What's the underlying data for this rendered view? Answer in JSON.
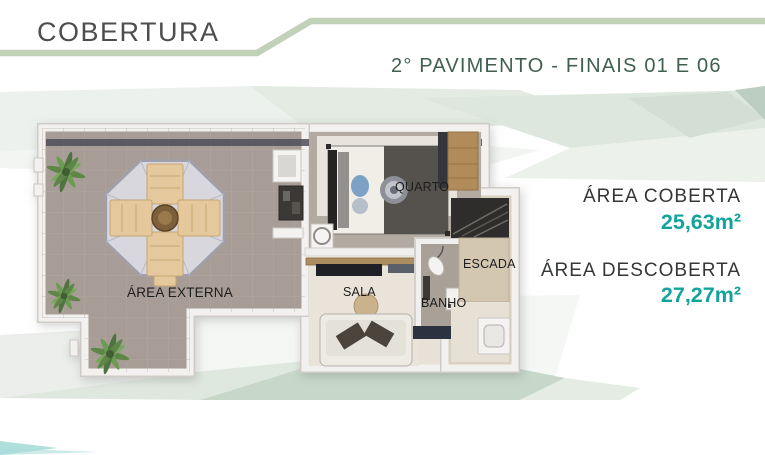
{
  "header": {
    "title": "COBERTURA",
    "subtitle": "2° PAVIMENTO - FINAIS 01 E 06"
  },
  "floor_plan": {
    "rooms": {
      "area_externa": "ÁREA EXTERNA",
      "quarto": "QUARTO",
      "sala": "SALA",
      "banho": "BANHO",
      "escada": "ESCADA"
    }
  },
  "areas": [
    {
      "label": "ÁREA COBERTA",
      "value": "25,63m²"
    },
    {
      "label": "ÁREA DESCOBERTA",
      "value": "27,27m²"
    }
  ],
  "colors": {
    "accent_teal": "#13a39d",
    "line_green": "#c1d2b8",
    "subtitle_green": "#40604f",
    "title_gray": "#4d4d4d"
  }
}
